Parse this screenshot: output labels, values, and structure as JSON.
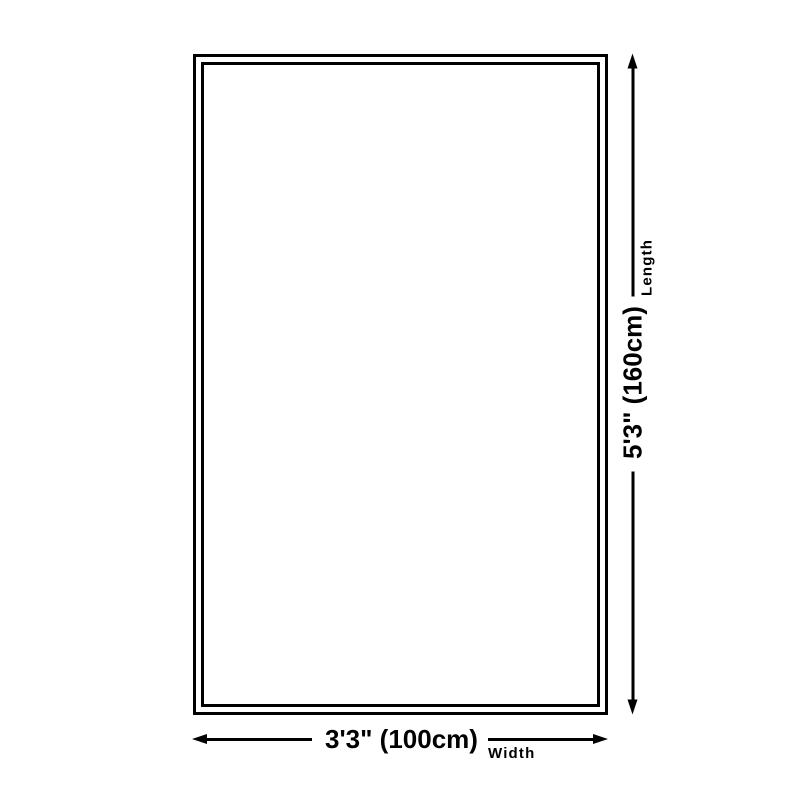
{
  "diagram": {
    "title": "rug-size-diagram",
    "colors": {
      "background": "#ffffff",
      "line": "#000000",
      "text": "#000000"
    },
    "dimensions": {
      "width": {
        "value": "3'3\" (100cm)",
        "label": "Width"
      },
      "length": {
        "value": "5'3\" (160cm)",
        "label": "Length"
      }
    }
  }
}
